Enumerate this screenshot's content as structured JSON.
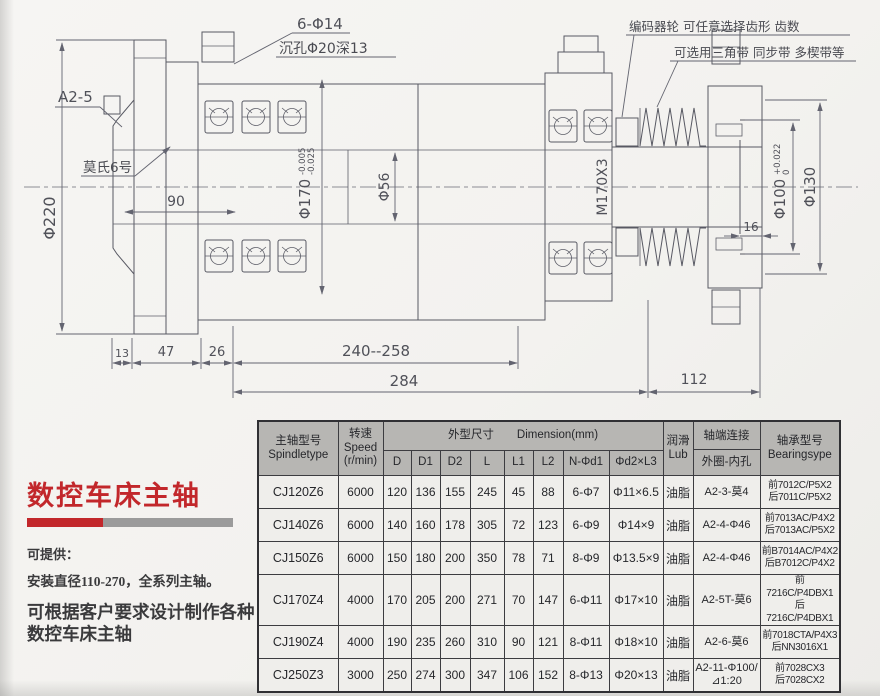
{
  "colors": {
    "accent_red": "#c2272b",
    "bar_gray": "#9b9b9b",
    "line": "#585963",
    "table_header_bg": "#b7b6b3"
  },
  "drawing": {
    "labels": {
      "bolt_holes": "6-Φ14",
      "counterbore": "沉孔Φ20深13",
      "encoder_note": "编码器轮 可任意选择齿形 齿数",
      "belt_note": "可选用三角带 同步带 多楔带等",
      "spindle_nose": "A2-5",
      "taper": "莫氏6号",
      "dia220": "Φ220",
      "dim90": "90",
      "dia170": "Φ170",
      "dia170_tol_upper": "-0.005",
      "dia170_tol_lower": "-0.025",
      "dia56": "Φ56",
      "thread": "M170X3",
      "dia100": "Φ100",
      "dia100_tol_upper": "+0.022",
      "dia100_tol_lower": "0",
      "dia130": "Φ130",
      "dim16": "16",
      "dim13": "13",
      "dim47": "47",
      "dim26": "26",
      "dim240_258": "240--258",
      "dim284": "284",
      "dim112": "112"
    }
  },
  "info_panel": {
    "title": "数控车床主轴",
    "offer_heading": "可提供：",
    "offer_line": "安装直径110-270，全系列主轴。",
    "custom_line1": "可根据客户要求设计制作各种",
    "custom_line2": "数控车床主轴"
  },
  "table": {
    "header": {
      "spindle_type": "主轴型号\nSpindletype",
      "speed": "转速\nSpeed\n(r/min)",
      "dimension_group": "外型尺寸　　Dimension(mm)",
      "dim_cols": [
        "D",
        "D1",
        "D2",
        "L",
        "L1",
        "L2",
        "N-Φd1",
        "Φd2×L3"
      ],
      "lub": "润滑\nLub",
      "shaft_end_top": "轴端连接",
      "shaft_end_bottom": "外圈-内孔",
      "bearing": "轴承型号\nBearingsype"
    },
    "rows": [
      {
        "model": "CJ120Z6",
        "speed": "6000",
        "dims": [
          "120",
          "136",
          "155",
          "245",
          "45",
          "88",
          "6-Φ7",
          "Φ11×6.5"
        ],
        "lub": "油脂",
        "shaft_end": "A2-3-莫4",
        "bearing": "前7012C/P5X2\n后7011C/P5X2"
      },
      {
        "model": "CJ140Z6",
        "speed": "6000",
        "dims": [
          "140",
          "160",
          "178",
          "305",
          "72",
          "123",
          "6-Φ9",
          "Φ14×9"
        ],
        "lub": "油脂",
        "shaft_end": "A2-4-Φ46",
        "bearing": "前7013AC/P4X2\n后7013AC/P5X2"
      },
      {
        "model": "CJ150Z6",
        "speed": "6000",
        "dims": [
          "150",
          "180",
          "200",
          "350",
          "78",
          "71",
          "8-Φ9",
          "Φ13.5×9"
        ],
        "lub": "油脂",
        "shaft_end": "A2-4-Φ46",
        "bearing": "前B7014AC/P4X2\n后B7012C/P4X2"
      },
      {
        "model": "CJ170Z4",
        "speed": "4000",
        "dims": [
          "170",
          "205",
          "200",
          "271",
          "70",
          "147",
          "6-Φ11",
          "Φ17×10"
        ],
        "lub": "油脂",
        "shaft_end": "A2-5T-莫6",
        "bearing": "前7216C/P4DBX1\n后7216C/P4DBX1"
      },
      {
        "model": "CJ190Z4",
        "speed": "4000",
        "dims": [
          "190",
          "235",
          "260",
          "310",
          "90",
          "121",
          "8-Φ11",
          "Φ18×10"
        ],
        "lub": "油脂",
        "shaft_end": "A2-6-莫6",
        "bearing": "前7018CTA/P4X3\n后NN3016X1"
      },
      {
        "model": "CJ250Z3",
        "speed": "3000",
        "dims": [
          "250",
          "274",
          "300",
          "347",
          "106",
          "152",
          "8-Φ13",
          "Φ20×13"
        ],
        "lub": "油脂",
        "shaft_end": "A2-11-Φ100/⊿1:20",
        "bearing": "前7028CX3\n后7028CX2"
      }
    ]
  }
}
